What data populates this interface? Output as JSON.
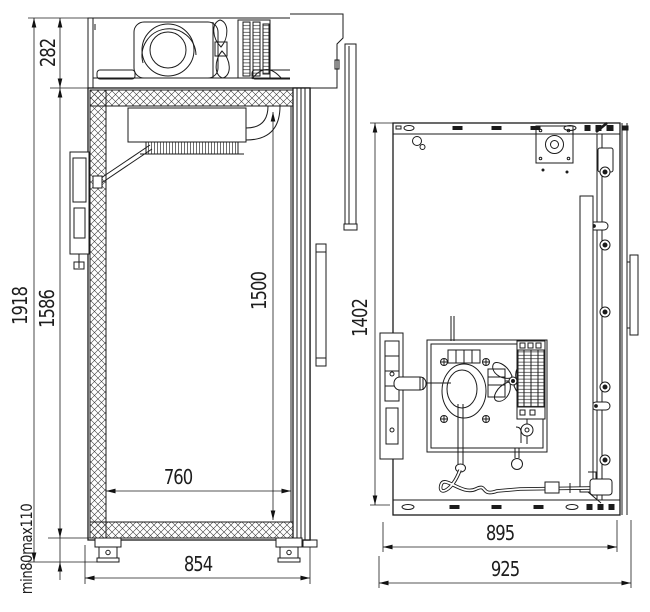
{
  "drawing": {
    "kind": "refrigerated-cabinet-technical-drawing",
    "line_color": "#1b1b1b",
    "background": "#ffffff",
    "views": {
      "side_section": {
        "label": "side-section-view",
        "components": [
          "compressor",
          "condenser-fan",
          "condenser-coil",
          "machine-compartment-cover",
          "insulated-wall",
          "evaporator",
          "air-duct-elbow",
          "drain-pipe",
          "rear-bracket",
          "door-panel",
          "door-handle",
          "adjustable-legs"
        ],
        "dims": {
          "machine_compartment_height": "282",
          "overall_height": "1918",
          "cabinet_body_height": "1586",
          "door_height": "1500",
          "leg_adjustment": "min80max110",
          "internal_depth": "760",
          "overall_depth": "854"
        }
      },
      "rear_view": {
        "label": "rear-view",
        "components": [
          "back-panel",
          "top-mounting-rail",
          "bottom-mounting-rail",
          "keyhole-slot",
          "gland-plate",
          "hinge-rail",
          "door-edge-flange",
          "door-handle",
          "compressor",
          "condenser-fan",
          "condenser-coil",
          "filter-drier",
          "serpentine-pipe",
          "machine-mounting-plate",
          "lower-hinge-bracket"
        ],
        "dims": {
          "panel_height": "1402",
          "body_width": "895",
          "overall_width": "925"
        }
      }
    }
  }
}
